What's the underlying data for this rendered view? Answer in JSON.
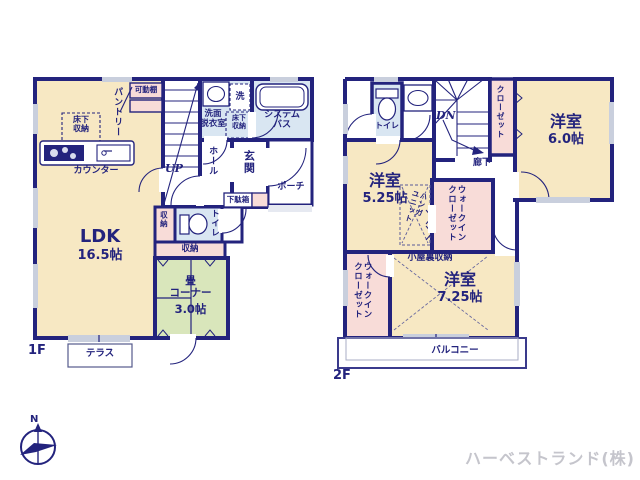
{
  "meta": {
    "floor1_label": "1F",
    "floor2_label": "2F",
    "company": "ハーベストランド(株)",
    "north": "N"
  },
  "f1": {
    "pantry": "パントリー",
    "movable_shelf": "可動棚",
    "underfloor_kitchen": "床下\n収納",
    "counter": "カウンター",
    "ldk_name": "LDK",
    "ldk_size": "16.5帖",
    "stairs_up": "UP",
    "washroom": "洗面\n脱衣室",
    "laundry": "洗",
    "underfloor_wash": "床下\n収納",
    "bath": "システム\nバス",
    "hall": "ホール",
    "entrance": "玄関",
    "shoebox": "下駄箱",
    "porch": "ポーチ",
    "storage_side": "収納",
    "toilet": "トイレ",
    "storage_strip": "収納",
    "tatami_name": "畳\nコーナー",
    "tatami_size": "3.0帖",
    "terrace": "テラス"
  },
  "f2": {
    "toilet": "トイレ",
    "stairs_down": "DN",
    "closet": "クローゼット",
    "room_a_name": "洋室",
    "room_a_size": "6.0帖",
    "hallway": "廊下",
    "room_b_name": "洋室",
    "room_b_size": "5.25帖",
    "hanger_unit": "ハンガ\nユニット",
    "wic_mid": "ウォークイン\nクローゼット",
    "attic": "小屋裏収納",
    "room_c_name": "洋室",
    "room_c_size": "7.25帖",
    "wic_left": "ウォークイン\nクローゼット",
    "balcony": "バルコニー"
  },
  "colors": {
    "wall": "#23237d",
    "room_cream": "#f7e8c3",
    "storage_pink": "#f8dcd8",
    "tatami_green": "#d9e6bb",
    "wet_blue": "#d9e6f2",
    "window_gray": "#c9cfdd",
    "company_gray": "#c5c5cc"
  }
}
